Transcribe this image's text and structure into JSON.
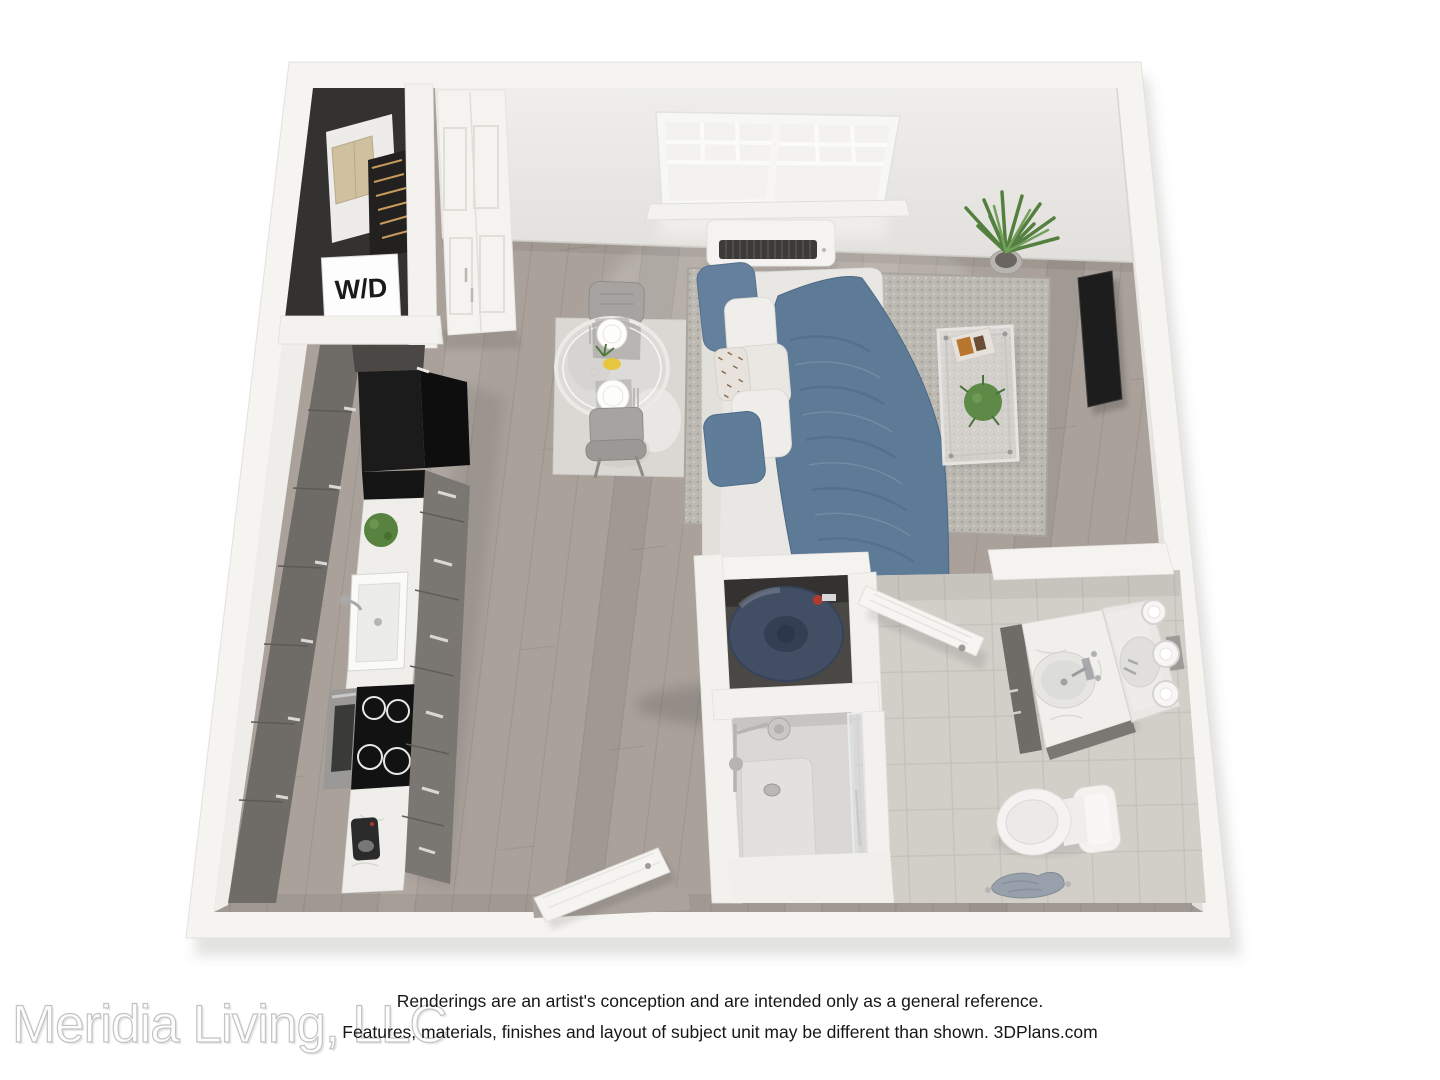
{
  "page": {
    "background": "#ffffff",
    "width_px": 1440,
    "height_px": 1080
  },
  "floorplan": {
    "view": "3D top-down rendering of a studio apartment",
    "labels": {
      "washer_dryer": "W/D"
    },
    "fixtures": [
      "washer-dryer-closet",
      "entry-closet",
      "kitchen-cabinets",
      "refrigerator",
      "cooktop",
      "oven",
      "kitchen-sink",
      "counter-plant",
      "coffee-maker",
      "dining-rug",
      "dining-table",
      "dining-chairs",
      "place-settings",
      "sofa-bed",
      "blue-throw-blanket",
      "pillows",
      "living-rug",
      "coffee-table",
      "wall-mounted-tv",
      "corner-plant",
      "double-hung-window",
      "wall-ac-unit",
      "water-heater-closet",
      "shower",
      "vanity",
      "vanity-mirror",
      "vanity-sconces",
      "toilet",
      "bath-mat",
      "bathroom-door",
      "entry-door"
    ],
    "colors": {
      "wall": "#f5f4f1",
      "wall_face": "#e9e7e3",
      "wood_floor": "#a9a19a",
      "tile_floor": "#d2cfc9",
      "cabinet_gray": "#6f6b67",
      "appliance_black": "#161616",
      "counter_marble": "#f1efec",
      "denim_blue": "#5d7a96",
      "plant_green": "#53803f",
      "water_heater_blue": "#414e63"
    }
  },
  "footer": {
    "disclaimer_line1": "Renderings are an artist's conception and are intended only as a general reference.",
    "disclaimer_line2": "Features, materials, finishes and layout of subject unit may be different than shown. 3DPlans.com",
    "watermark": "Meridia Living, LLC"
  }
}
